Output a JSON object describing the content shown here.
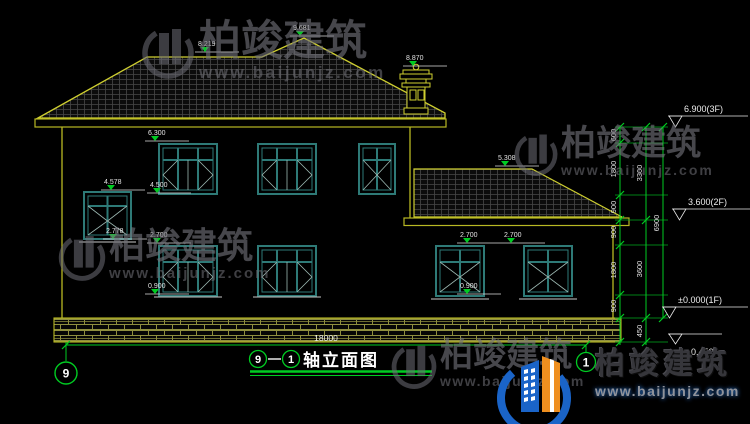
{
  "title": {
    "axis_start": "9",
    "axis_end": "1",
    "name": "轴立面图"
  },
  "axes": {
    "left_bubble": "9",
    "right_bubble": "1"
  },
  "dimensions": {
    "overall_width": "18000",
    "chain_inner": [
      "600",
      "1800",
      "900",
      "900",
      "1800",
      "900"
    ],
    "chain_mid": [
      "3300",
      "3600",
      "450"
    ],
    "chain_outer": [
      "6900"
    ]
  },
  "levels_right": {
    "floor3": "6.900(3F)",
    "floor2": "3.600(2F)",
    "floor1": "±0.000(1F)",
    "ground": "-0.450"
  },
  "levels": {
    "ridge_low": "8.219",
    "ridge_peak": "9.681",
    "chimney_top": "8.870",
    "window2f_head": "6.300",
    "stair_window_head": "4.578",
    "window2f_sill": "4.500",
    "stair_window_sill": "2.778",
    "window1f_head": "2.700",
    "window1f_sill": "0.900",
    "annex_ridge": "5.308",
    "annex_window_head_1": "2.700",
    "annex_window_head_2": "2.700",
    "annex_window_sill": "0.900"
  },
  "watermark": {
    "brand": "柏竣建筑",
    "url": "www.baijunjz.com"
  },
  "colors": {
    "line_yellow": "#c2c226",
    "dim_green": "#00cc22",
    "window_teal": "#2e7a77",
    "text_white": "#e5e5e5"
  }
}
